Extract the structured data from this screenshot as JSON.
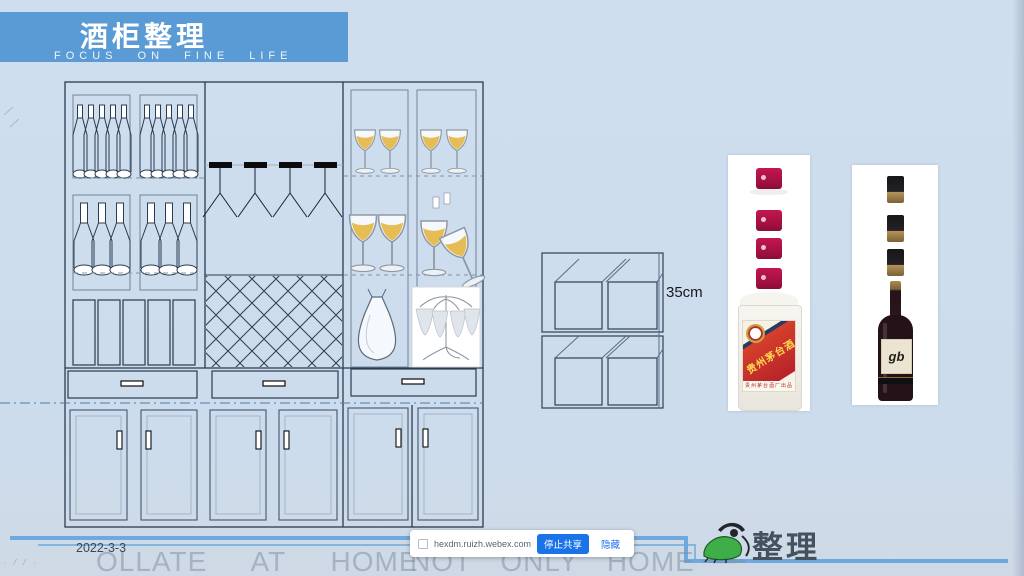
{
  "header": {
    "title": "酒柜整理",
    "subtitle": "FOCUS   ON   FINE   LIFE"
  },
  "stack_diagram": {
    "dimension_label": "35cm"
  },
  "bottle_images": {
    "moutai_label": "贵州茅台酒",
    "moutai_footer": "贵州茅台酒厂出品",
    "wine_label": "gb"
  },
  "share_bar": {
    "message": "hexdm.ruizh.webex.com 正在共享你的屏幕。",
    "stop_button": "停止共享",
    "hide_button": "隐藏"
  },
  "footer": {
    "date": "2022-3-3",
    "watermark_left": "OLLATE AT HOME",
    "watermark_right": "NOT ONLY HOME",
    "corner_marks": "∙ ⁄ ⁄ ∙",
    "logo_text": "整理"
  },
  "colors": {
    "header_bg": "#5b9bd5",
    "slide_bg": "#ccdcec",
    "line_blue": "#6fa8dc",
    "cabinet_line": "#2a3b52",
    "share_button_blue": "#1a73e8",
    "moutai_red": "#c9302b",
    "moutai_cap_red": "#a6114a",
    "wine_dark": "#241218",
    "logo_green": "#3fae49"
  }
}
